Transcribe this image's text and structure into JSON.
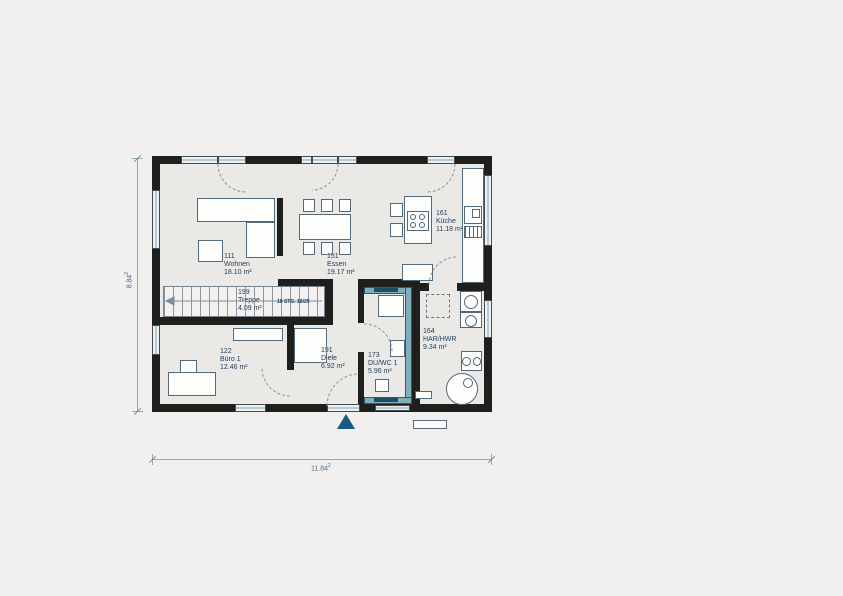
{
  "floorplan": {
    "rooms": [
      {
        "number": "111",
        "name": "Wohnen",
        "area": "18.10 m²"
      },
      {
        "number": "151",
        "name": "Essen",
        "area": "19.17 m²"
      },
      {
        "number": "161",
        "name": "Küche",
        "area": "11.18 m²"
      },
      {
        "number": "199",
        "name": "Treppe",
        "area": "4.09 m²"
      },
      {
        "number": "122",
        "name": "Büro 1",
        "area": "12.46 m²"
      },
      {
        "number": "191",
        "name": "Diele",
        "area": "6.92 m²"
      },
      {
        "number": "173",
        "name": "DU/WC 1",
        "area": "5.96 m²"
      },
      {
        "number": "164",
        "name": "HAR/HWR",
        "area": "9.34 m²"
      }
    ],
    "stair": {
      "steps_note": "18 STG. 18/25"
    },
    "dimensions": {
      "width": "11.84",
      "width_sup": "2",
      "height": "8.84",
      "height_sup": "2"
    },
    "colors": {
      "wall": "#1f1f1d",
      "label_text": "#1d3c5c",
      "installation_wall": "#7fafbc",
      "entrance_arrow": "#1b5a80",
      "window_fill": "#eef1f2",
      "background": "#f1f0ee"
    }
  }
}
